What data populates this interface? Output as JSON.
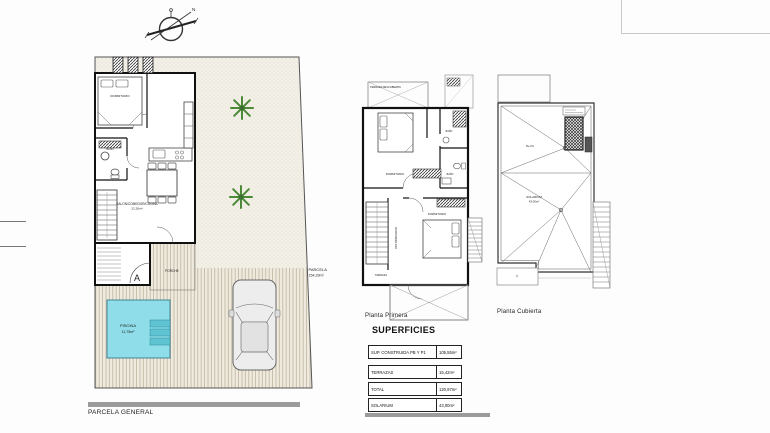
{
  "sheet": {
    "compass": {
      "north": "N"
    },
    "captions": {
      "ground": "PARCELA GENERAL",
      "first": "Planta Primera",
      "roof": "Planta Cubierta"
    },
    "ground_floor": {
      "parcel_name": "PARCELA",
      "parcel_area": "154,29m²",
      "dormitorio": "DORMITORIO",
      "bano": "BAÑO",
      "salon": "SALON/COMEDOR/COCINA",
      "salon_area": "21,26m²",
      "porche": "PORCHE",
      "piscina": "PISCINA",
      "piscina_area": "11,75m²",
      "section_a": "A"
    },
    "first_floor": {
      "terraza_descubierta": "TERRAZA DESCUBIERTA",
      "dormitorio1": "DORMITORIO",
      "bano1": "BAÑO",
      "bano2": "BAÑO",
      "distribuidor": "DISTRIBUIDOR",
      "dormitorio2": "DORMITORIO",
      "terraza": "TERRAZA"
    },
    "roof_plan": {
      "solarium": "SOLARIUM",
      "solarium_area": "43,00m²",
      "slope": "Pte 2%"
    },
    "superficies": {
      "title": "SUPERFICIES",
      "rows": [
        {
          "label": "SUP. CONSTRUIDA PB Y P1",
          "value": "105,55m²"
        },
        {
          "label": "TERRAZAS",
          "value": "15,42m²"
        },
        {
          "label": "TOTAL",
          "value": "120,97m²"
        },
        {
          "label": "SOLARIUM",
          "value": "43,00m²"
        }
      ]
    },
    "colors": {
      "pool": "#8edde8",
      "pool_steps": "#5fc3d2",
      "plant_green": "#4c8a38",
      "deck": "#efeadd",
      "garden": "#f3f0e8"
    }
  }
}
